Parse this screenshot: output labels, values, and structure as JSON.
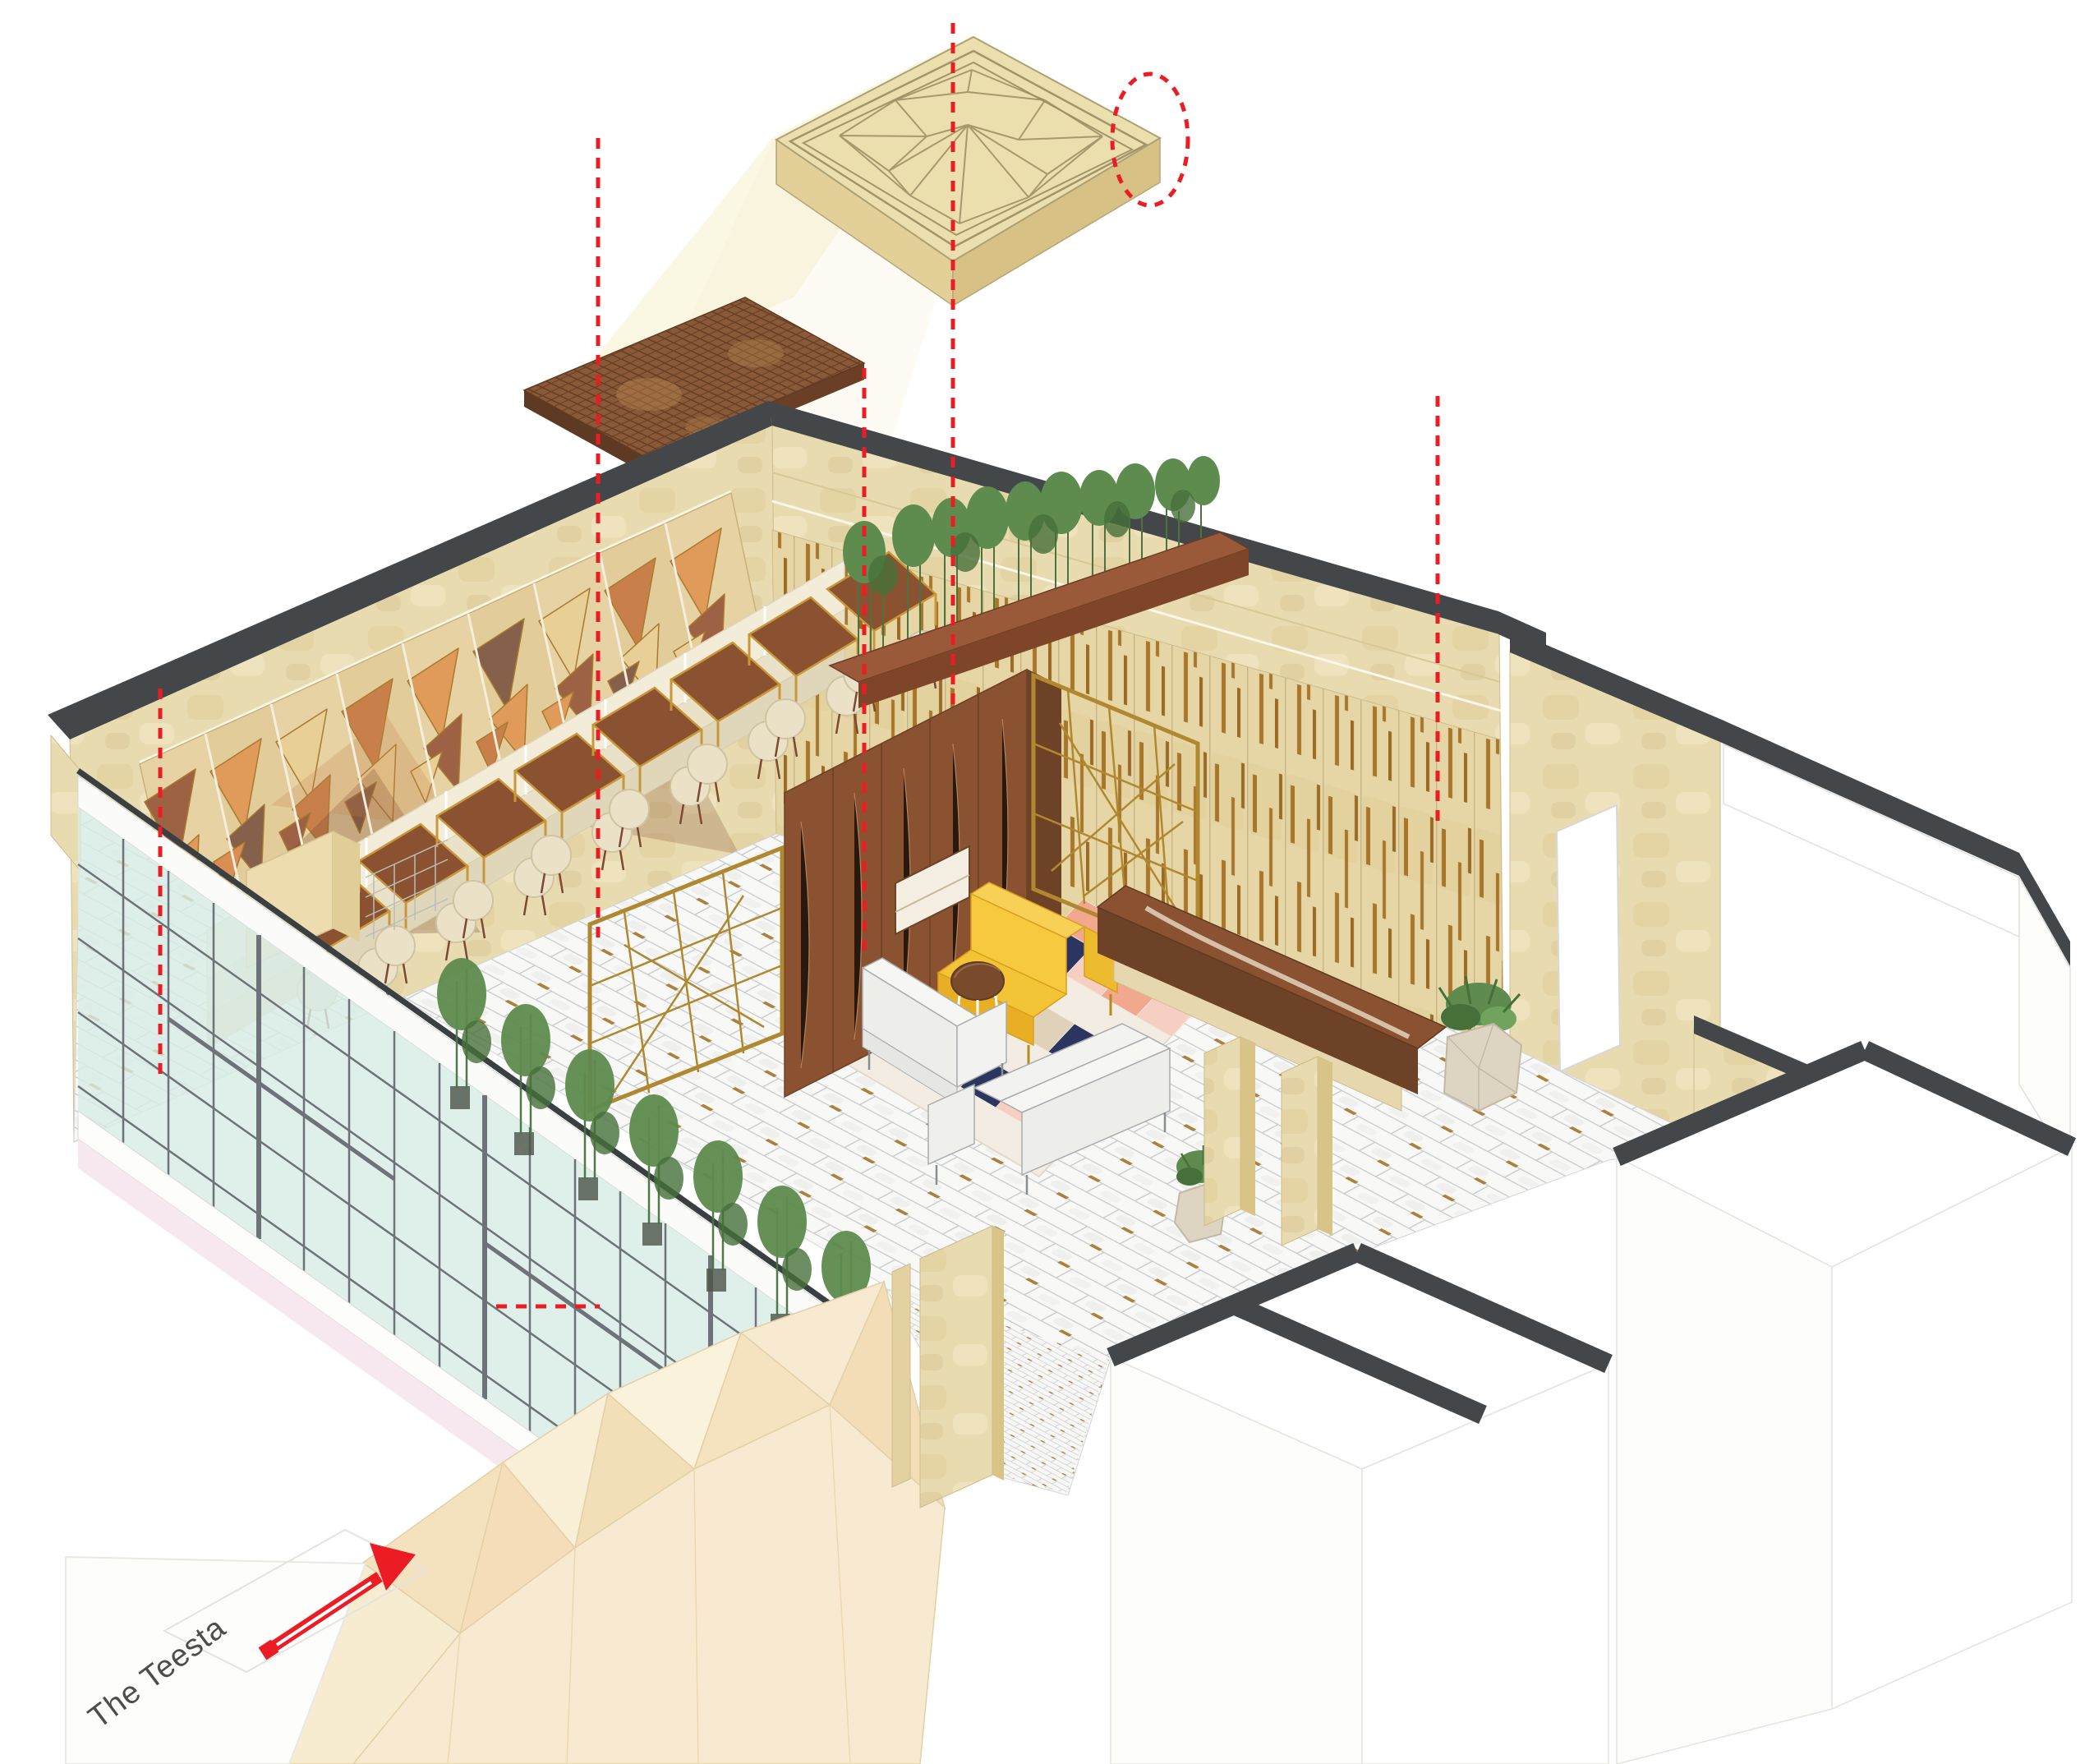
{
  "annotation": {
    "label": "The Teesta"
  },
  "drawing": {
    "kind": "exploded-axonometric-interior",
    "elements": [
      "sculpted-ceiling-panel",
      "ceiling-detail-callout-circle",
      "perforated-copper-ceiling-panel",
      "geometric-timber-mural-wall",
      "travertine-wall-brass-inlay",
      "dining-banquette",
      "dining-tables",
      "dining-chairs",
      "walnut-partition",
      "brass-lattice-screens",
      "lounge-yellow-sofa",
      "lounge-white-sofas",
      "round-coffee-table",
      "geometric-rug",
      "reception-console",
      "stone-planters",
      "bamboo-planting",
      "glass-facade",
      "marble-floor",
      "faceted-entry-wall",
      "back-of-house-rooms",
      "entry-arrow"
    ]
  },
  "palette": {
    "red_accent": "#ec1c24",
    "ceiling_beige": "#ecdfae",
    "copper": "#8a5a38",
    "travertine": "#e9dbb0",
    "brass": "#a8762a",
    "walnut": "#8a5230",
    "wall_cut_charcoal": "#43474a",
    "glass": "#d8ebe5",
    "rug_navy": "#2c3460",
    "rug_blush": "#f2a88e",
    "sofa_yellow": "#f6c93e",
    "mural_orange": "#e09a5a",
    "plant_green": "#5e8b4e",
    "facet_cream": "#f6e8c8"
  }
}
